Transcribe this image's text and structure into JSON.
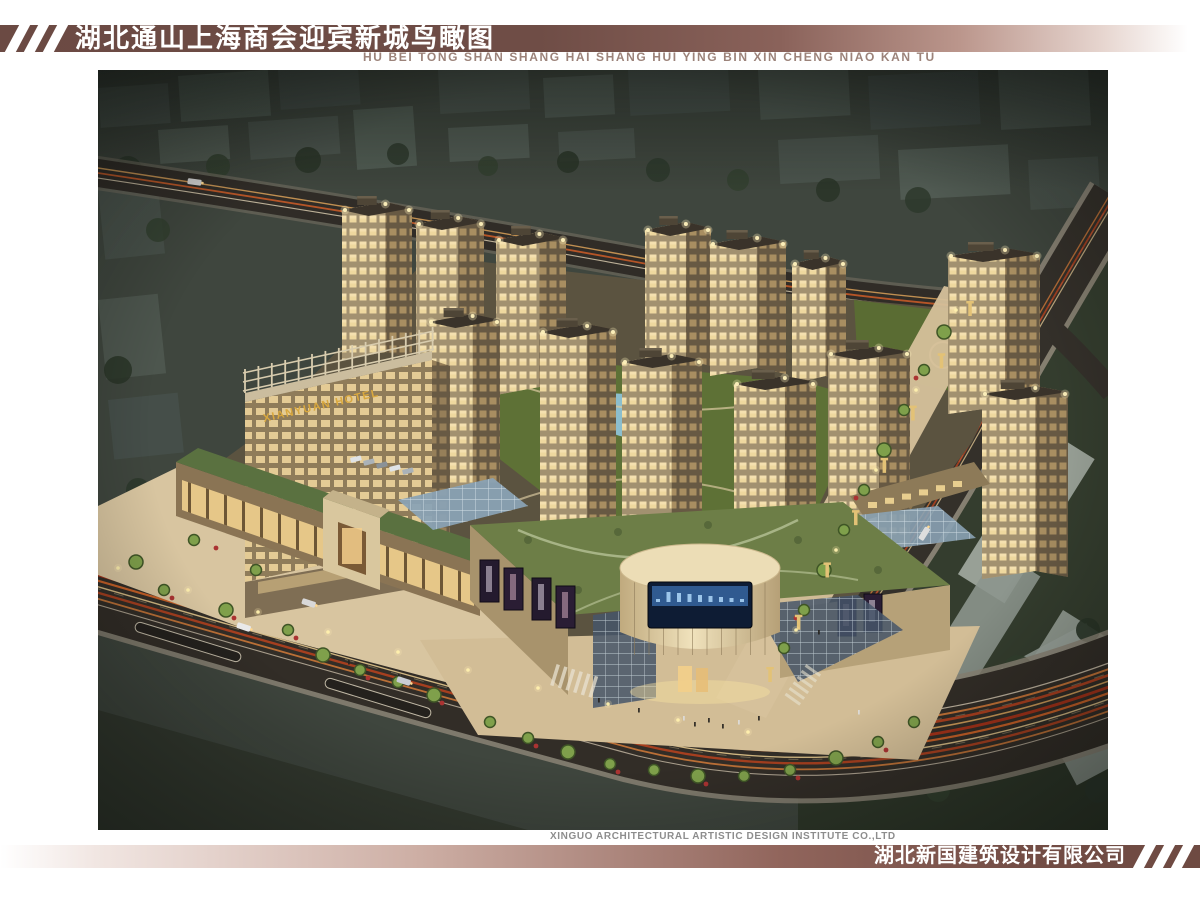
{
  "header": {
    "title": "湖北通山上海商会迎宾新城鸟瞰图",
    "pinyin": "HU BEI TONG SHAN SHANG HAI SHANG HUI YING BIN XIN CHENG NIAO KAN TU"
  },
  "artwork": {
    "hotel_sign": "XIANYUAN HOTEL"
  },
  "footer": {
    "institute": "XINGUO ARCHITECTURAL ARTISTIC DESIGN INSTITUTE CO.,LTD",
    "company": "湖北新国建筑设计有限公司"
  },
  "colors": {
    "bar_maroon": "#6e4a42",
    "pinyin_brown": "#9c837a",
    "institute_gray": "#8d8d8d",
    "trail_red": "#b03318",
    "trail_orange": "#e06a28",
    "facade_beige": "#c9b893",
    "lawn_green": "#5e7136",
    "hotel_sign_gold": "#d9a83e",
    "led_screen_blue": "#3a6aa8"
  }
}
